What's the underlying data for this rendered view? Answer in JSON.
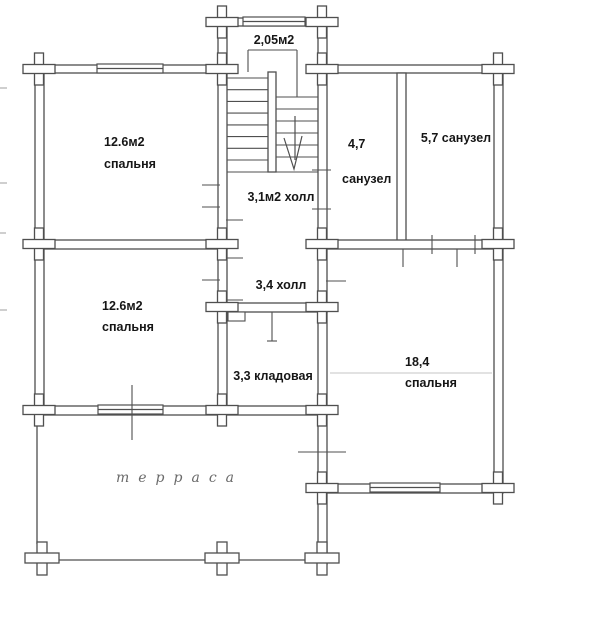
{
  "rooms": {
    "stairs": {
      "label": "2,05м2"
    },
    "bedroom_top_left": {
      "line1": "12.6м2",
      "line2": "спальня"
    },
    "hall_upper": {
      "label": "3,1м2 холл"
    },
    "bathroom_small": {
      "line1": "4,7",
      "line2": "санузел"
    },
    "bathroom_large": {
      "label": "5,7 санузел"
    },
    "hall_lower": {
      "label": "3,4 холл"
    },
    "bedroom_mid_left": {
      "line1": "12.6м2",
      "line2": "спальня"
    },
    "storage": {
      "label": "3,3 кладовая"
    },
    "bedroom_large": {
      "line1": "18,4",
      "line2": "спальня"
    },
    "terrace": {
      "label": "терраса"
    }
  },
  "colors": {
    "ink": "#4f4f4f",
    "labels": "#161616",
    "terrace_ink": "#6a6a6a",
    "paper": "#ffffff"
  }
}
